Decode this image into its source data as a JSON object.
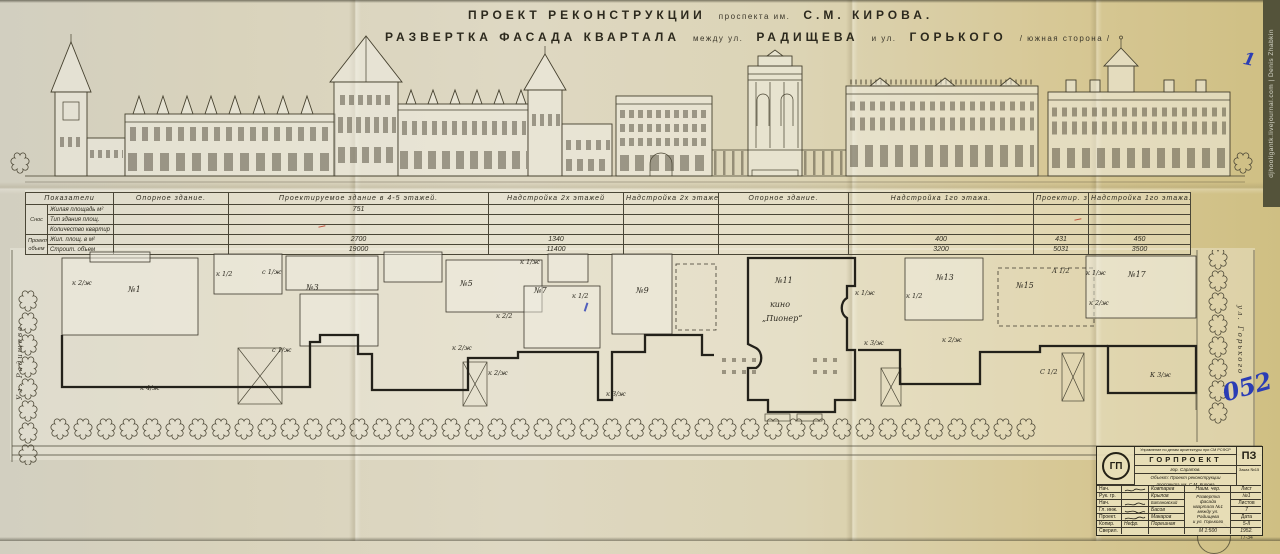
{
  "colors": {
    "paper": "#dcd5ba",
    "paper_right": "#d4c68e",
    "ink": "#3a362a",
    "blue_pen": "#2b3db5",
    "red_pen": "#b43a2a"
  },
  "header": {
    "t1a": "ПРОЕКТ РЕКОНСТРУКЦИИ",
    "t1b": "проспекта им.",
    "t1c": "С.М. КИРОВА.",
    "t2a": "РАЗВЕРТКА ФАСАДА КВАРТАЛА",
    "t2b": "между ул.",
    "t2c": "РАДИЩЕВА",
    "t2d": "и ул.",
    "t2e": "ГОРЬКОГО",
    "t2f": "/ южная сторона /"
  },
  "table": {
    "headers": [
      "Показатели",
      "Опорное здание.",
      "Проектируемое здание в 4-5 этажей.",
      "Надстройка 2х этажей",
      "Надстройка 2х этажей.",
      "Опорное здание.",
      "Надстройка 1го этажа.",
      "Проектир. здан. 4 эт.",
      "Надстройка 1го этажа."
    ],
    "group1": "Снос",
    "group2_l1": "Проект.",
    "group2_l2": "объем",
    "rows": [
      [
        "Жилая площадь м²",
        "",
        "751",
        "",
        "",
        "",
        "",
        "",
        ""
      ],
      [
        "Тип здания площ.",
        "",
        "",
        "",
        "",
        "",
        "",
        "",
        ""
      ],
      [
        "Количество квартир",
        "",
        "",
        "",
        "",
        "",
        "",
        "",
        ""
      ],
      [
        "Жил. площ. в м²",
        "",
        "2700",
        "1340",
        "",
        "",
        "400",
        "431",
        "450"
      ],
      [
        "Строит. объем",
        "",
        "19000",
        "11400",
        "",
        "",
        "3200",
        "5031",
        "3500"
      ]
    ]
  },
  "plan": {
    "street_left": "Ул. Радищева",
    "street_right": "ул. Горького",
    "numbers": [
      "№1",
      "№3",
      "№5",
      "№7",
      "№9",
      "№11",
      "№13",
      "№15",
      "№17"
    ],
    "cinema_line1": "кино",
    "cinema_line2": "„Пионер“",
    "codes": [
      "к 2/ж",
      "к 1/2",
      "с 1/ж",
      "с 1/ж",
      "к 4/ж",
      "к 2/ж",
      "к 1/ж",
      "к 2/2",
      "к 1/2",
      "к 2/ж",
      "к 3/ж",
      "к 1/ж",
      "к 3/ж",
      "к 2/ж",
      "А 1/2",
      "к 1/ж",
      "к 2/ж",
      "С 1/2",
      "К 3/ж",
      "к 1/2"
    ]
  },
  "stamp": {
    "org_small": "Управление по делам архитектуры при СМ РСФСР",
    "org": "ГОРПРОЕКТ",
    "city": "гор. Саратов.",
    "object_line1": "Объект: Проект реконструкции",
    "object_line2": "проспекта им. С.М. Кирова",
    "doc_code": "ПЗ",
    "order_no": "Заказ №15",
    "logo": "ГП",
    "name_col_header": "Наим. чер.",
    "drawing_name": {
      "l1": "Развертка",
      "l2": "фасада",
      "l3": "квартала №1",
      "l4": "между ул. Радищева",
      "l5": "и ул. Горького"
    },
    "sheet_label": "Лист",
    "sheet_no": "№1",
    "sheets_label": "Листов",
    "sheets_total": "7",
    "date_label": "Дата",
    "date_value": "5-II",
    "scale": "М 1:500",
    "year": "1952.",
    "copier_sig": "Нефр.",
    "archive_no": "77-34",
    "roles": [
      {
        "role": "Нач. С.П.",
        "name": "Ковтарев"
      },
      {
        "role": "Рук. гр.",
        "name": "Крылов"
      },
      {
        "role": "Нач. сект",
        "name": "Батановский"
      },
      {
        "role": "Гл. инж.",
        "name": "Басов"
      },
      {
        "role": "Проект.",
        "name": "Макаров"
      },
      {
        "role": "Копир.",
        "name": "Порешная"
      },
      {
        "role": "Сверил.",
        "name": ""
      }
    ]
  },
  "annotations": {
    "blue_052": "052",
    "blue_1": "1"
  },
  "watermark": "djhooligantk.livejournal.com | Denis Zhabkin"
}
